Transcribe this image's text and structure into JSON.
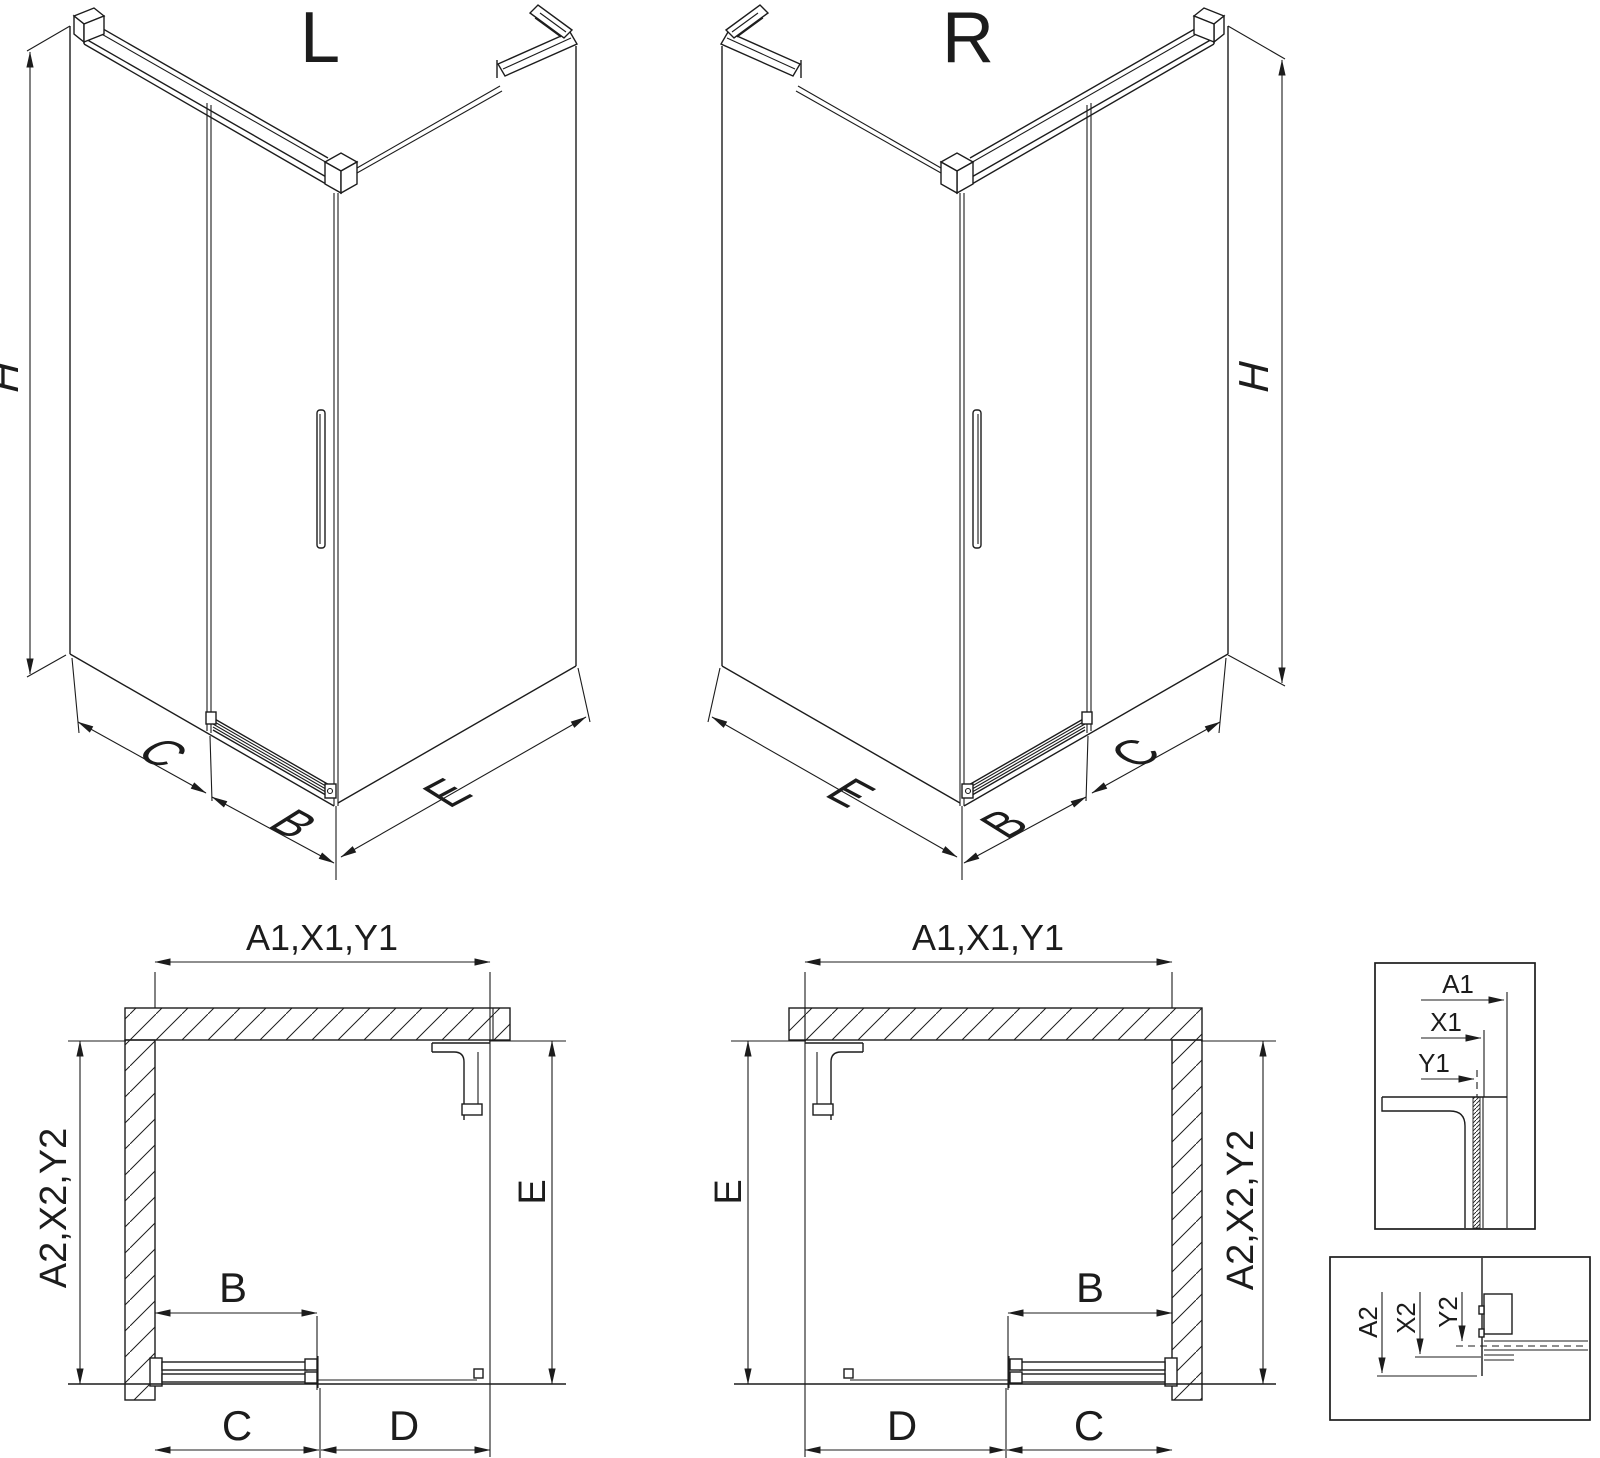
{
  "drawing": {
    "iso_left": {
      "title": "L",
      "height_label": "H",
      "side_label": "C",
      "door_label": "B",
      "return_label": "E"
    },
    "iso_right": {
      "title": "R",
      "height_label": "H",
      "side_label": "C",
      "door_label": "B",
      "return_label": "E"
    },
    "plan_left": {
      "top_dim": "A1,X1,Y1",
      "wall_dim": "A2,X2,Y2",
      "door_dim": "B",
      "fixed_dim": "C",
      "opening_dim": "D",
      "return_dim": "E"
    },
    "plan_right": {
      "top_dim": "A1,X1,Y1",
      "wall_dim": "A2,X2,Y2",
      "door_dim": "B",
      "fixed_dim": "C",
      "opening_dim": "D",
      "return_dim": "E"
    },
    "detail_top": {
      "dims": [
        "A1",
        "X1",
        "Y1"
      ]
    },
    "detail_bottom": {
      "dims": [
        "A2",
        "X2",
        "Y2"
      ]
    }
  },
  "colors": {
    "line": "#1c1c1c",
    "background": "#ffffff"
  }
}
